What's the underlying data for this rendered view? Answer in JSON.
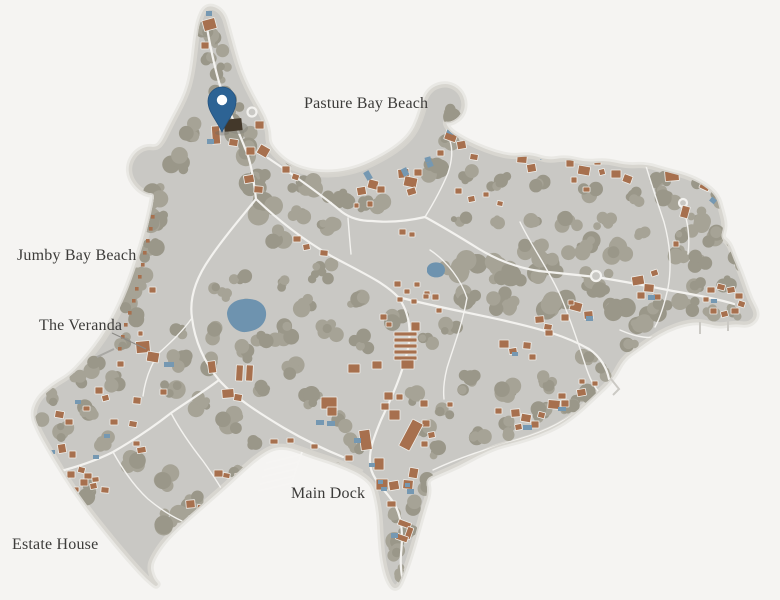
{
  "map_labels": {
    "pasture_bay_beach": "Pasture Bay Beach",
    "jumby_bay_beach": "Jumby Bay Beach",
    "the_veranda": "The Veranda",
    "main_dock": "Main Dock",
    "estate_house": "Estate House"
  },
  "marker": {
    "name": "location-pin",
    "color": "#2d6394",
    "inner_dot_color": "#ffffff"
  },
  "palette": {
    "background": "#f5f4f2",
    "island": "#c9c8c4",
    "island_edge": "#d8d6d0",
    "island_halo": "#e9e8e4",
    "beach_sand": "#d6d4ce",
    "vegetation_a": "#a6a396",
    "vegetation_b": "#9a9789",
    "building": "#a7704e",
    "building_outline": "#efeeea",
    "dark_building": "#43382a",
    "road": "#f3f2ef",
    "pond": "#6e93af",
    "pool": "#7598b2",
    "label_text": "#3c3b39",
    "leader_line": "#8b8a86"
  }
}
